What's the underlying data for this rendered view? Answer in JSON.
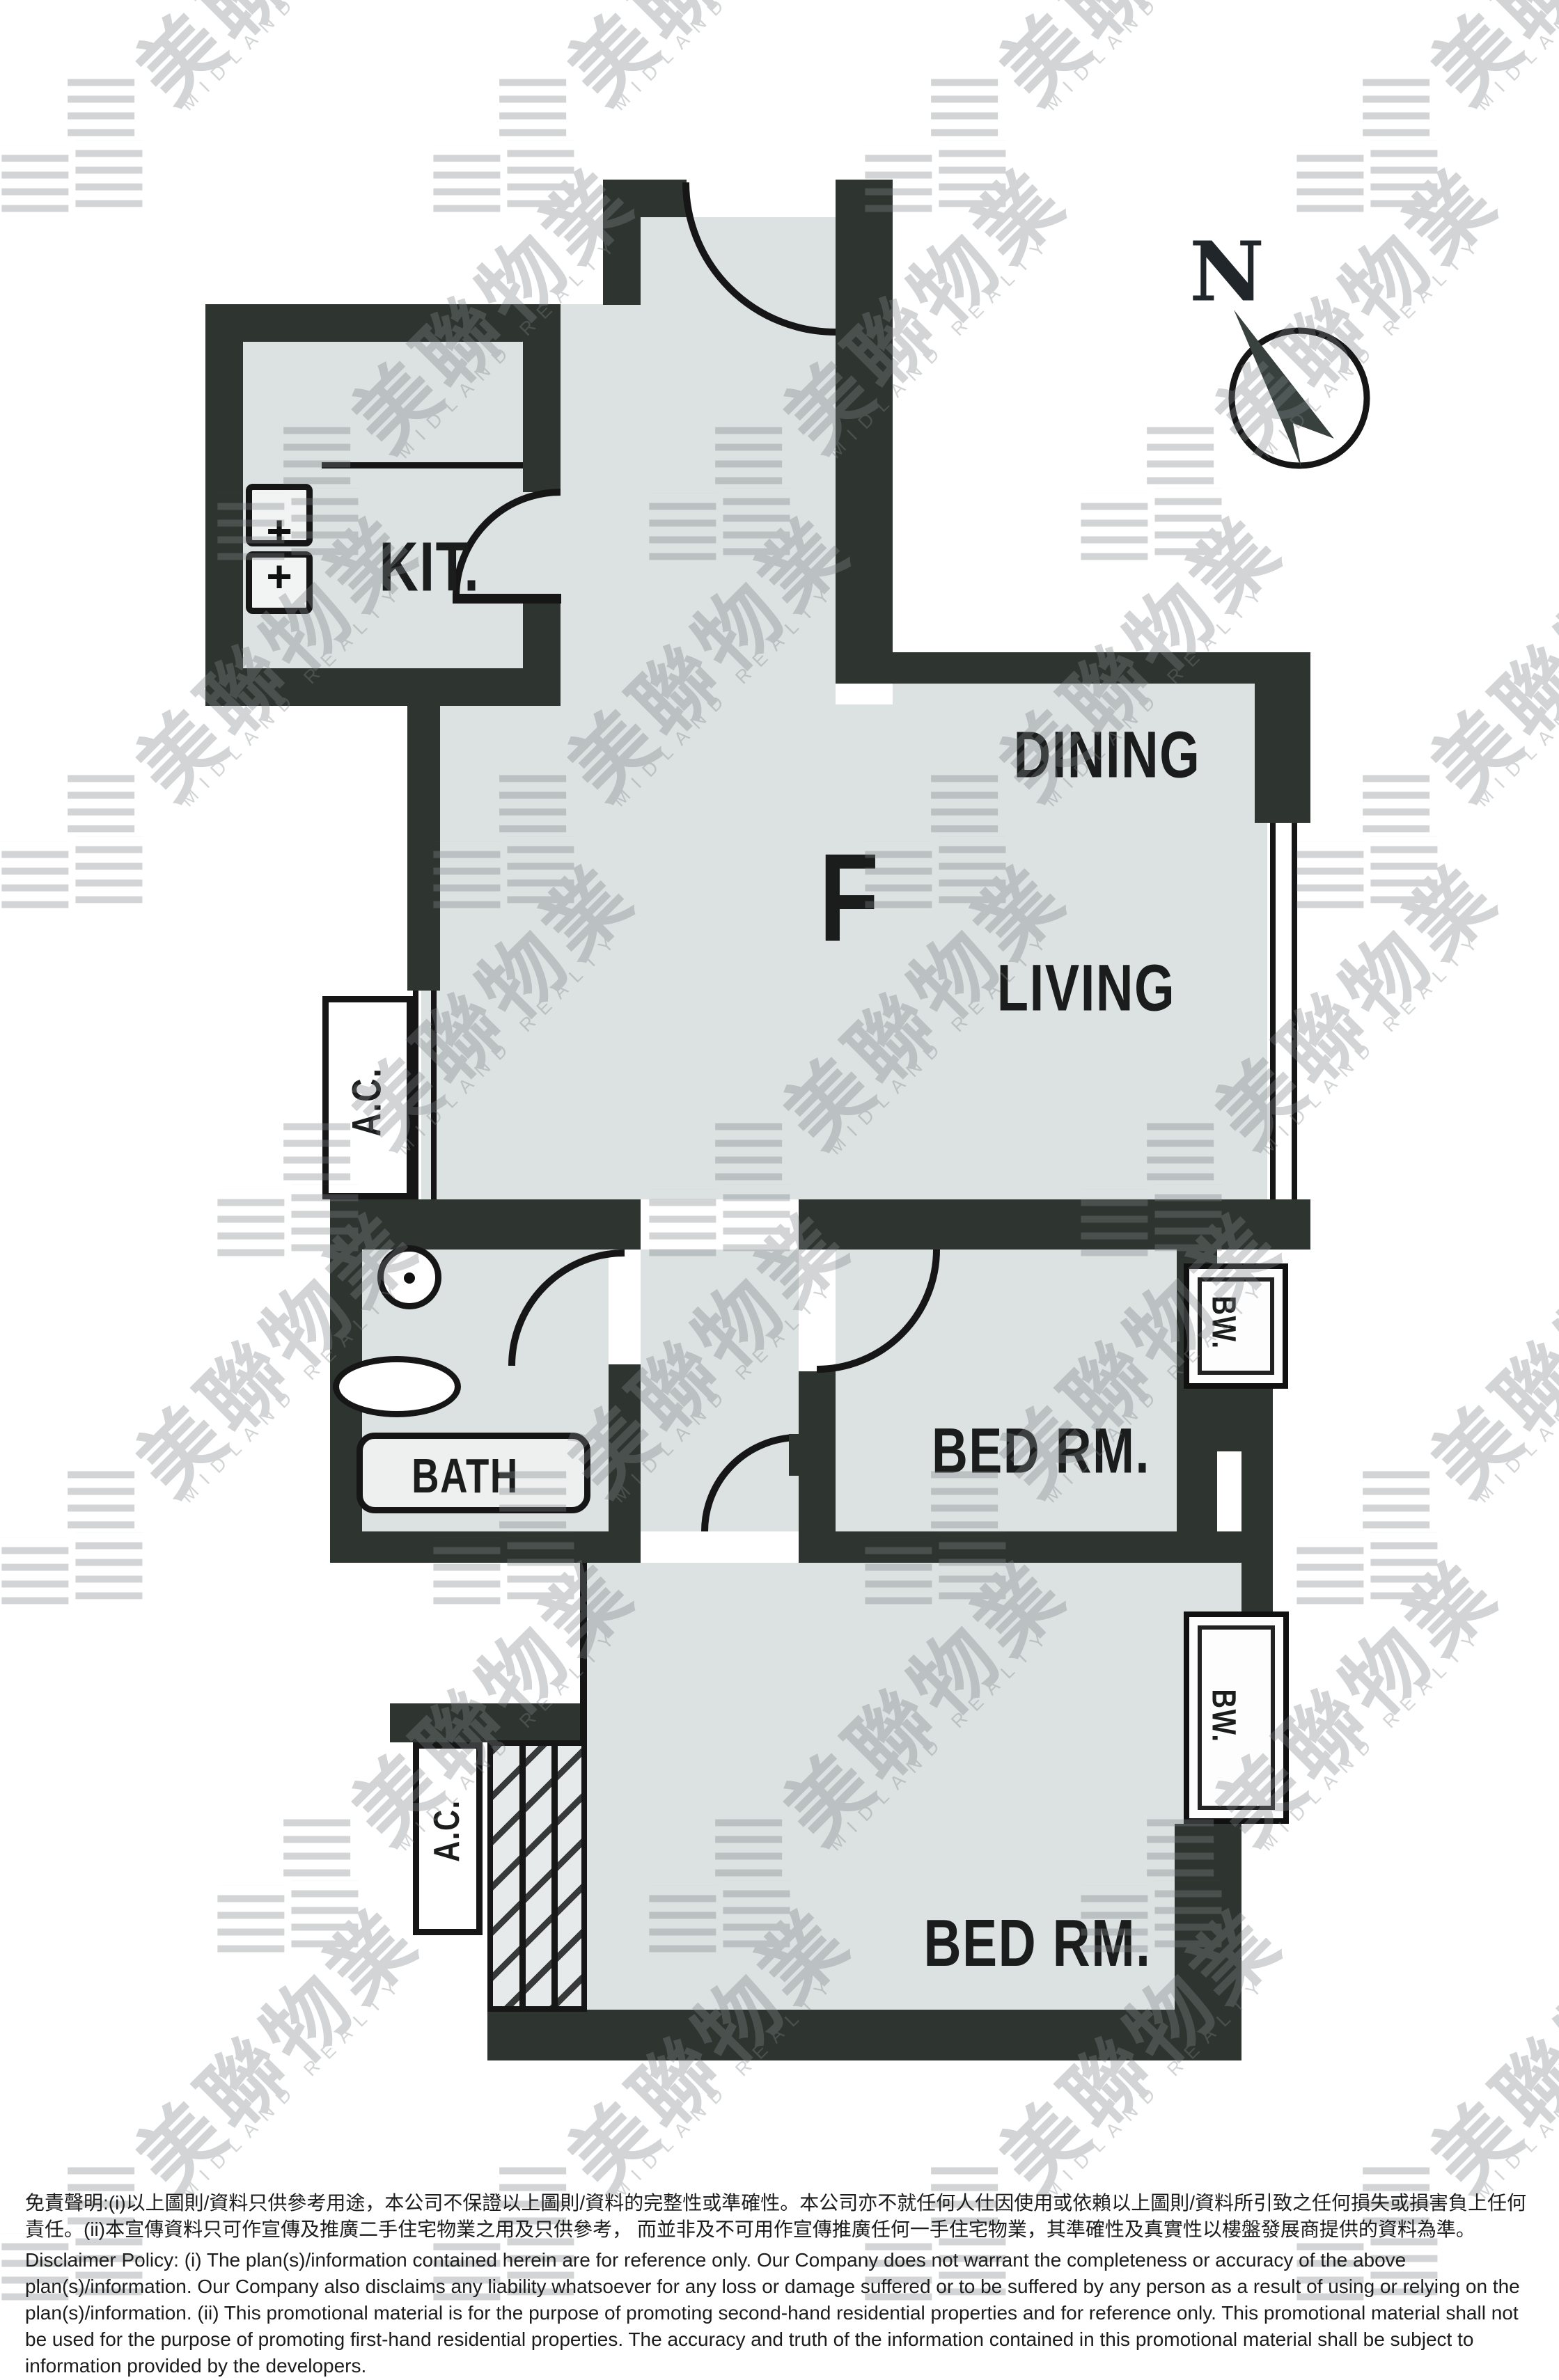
{
  "compass": {
    "north_label": "N"
  },
  "rooms": {
    "kitchen": "KIT.",
    "dining": "DINING",
    "living": "LIVING",
    "unit_letter": "F",
    "bed_rm_1": "BED RM.",
    "bed_rm_2": "BED RM.",
    "bath": "BATH",
    "ac_1": "A.C.",
    "ac_2": "A.C.",
    "bw_1": "BW.",
    "bw_2": "BW."
  },
  "fixtures": {
    "sink_cross_1": "+",
    "sink_cross_2": "+"
  },
  "watermark": {
    "cn": "美聯物業",
    "en": "MIDLAND REALTY"
  },
  "disclaimer": {
    "zh": "免責聲明:(i)以上圖則/資料只供參考用途，本公司不保證以上圖則/資料的完整性或準確性。本公司亦不就任何人仕因使用或依賴以上圖則/資料所引致之任何損失或損害負上任何責任。(ii)本宣傳資料只可作宣傳及推廣二手住宅物業之用及只供參考， 而並非及不可用作宣傳推廣任何一手住宅物業，其準確性及真實性以樓盤發展商提供的資料為準。",
    "en": "Disclaimer Policy: (i) The plan(s)/information contained herein are for reference only. Our Company does not warrant the completeness or accuracy of the above plan(s)/information. Our Company also disclaims any liability whatsoever for any loss or damage suffered or to be suffered by any person as a result of using or relying on the plan(s)/information. (ii) This promotional material is for the purpose of promoting second-hand residential properties and for reference only. This promotional material shall not be used for the purpose of promoting first-hand residential properties. The accuracy and truth of the information contained in this promotional material shall be subject to information provided by the developers."
  },
  "colors": {
    "wall": "#2e3531",
    "floor": "#dce1e2",
    "line": "#161616",
    "watermark": "#7e8486"
  }
}
